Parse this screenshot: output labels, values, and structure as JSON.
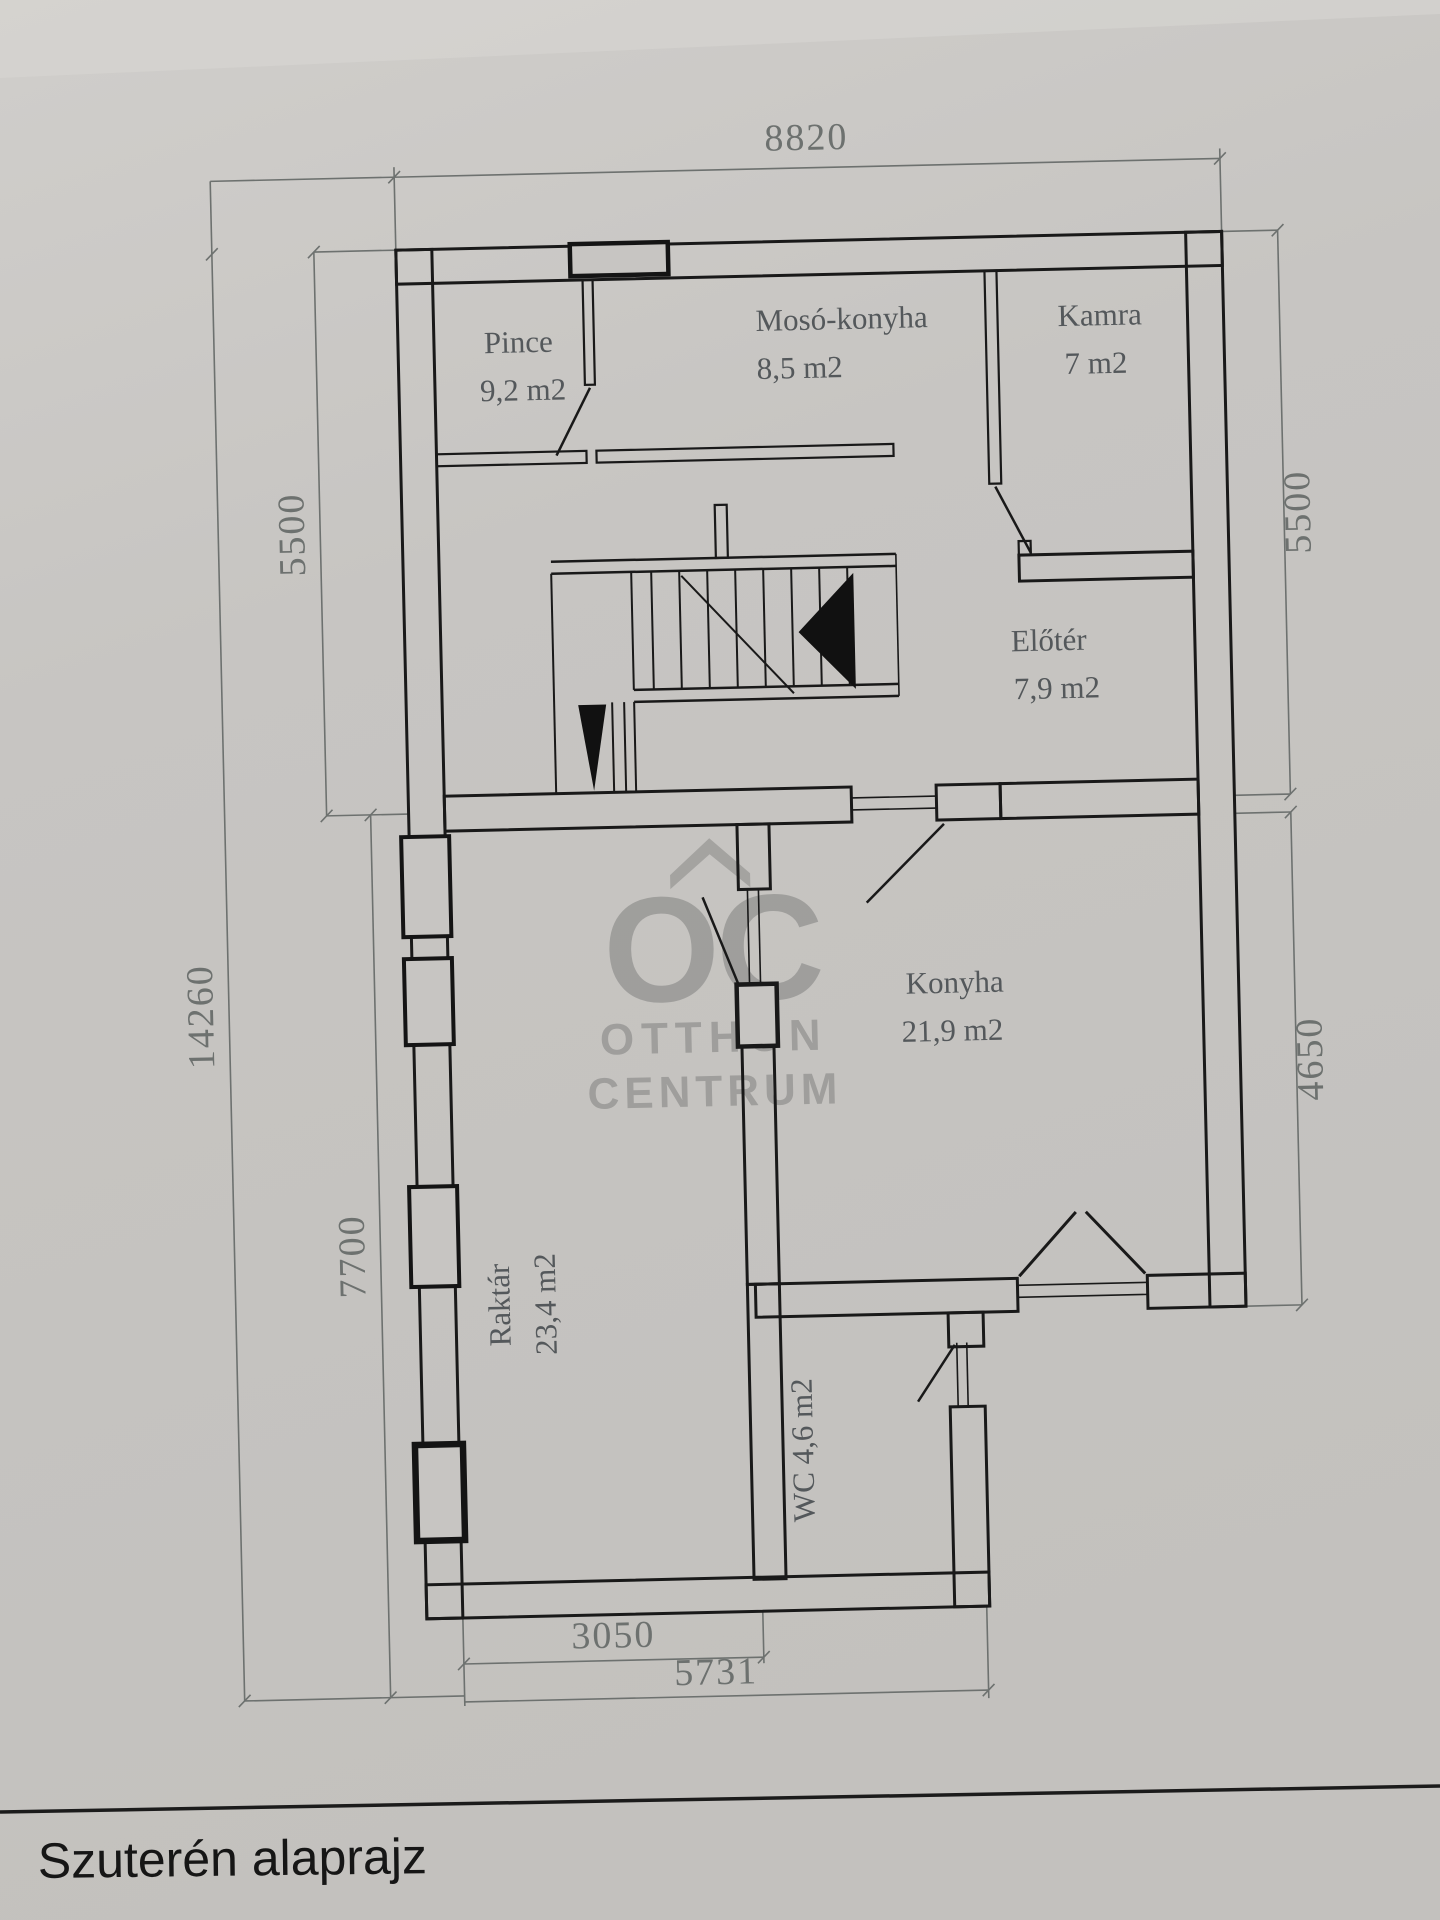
{
  "title": "Szuterén alaprajz",
  "watermark": {
    "logo": "OC",
    "line1": "OTTHON",
    "line2": "CENTRUM"
  },
  "dimensions": {
    "top": "8820",
    "left_upper": "5500",
    "right_upper": "5500",
    "left_total": "14260",
    "left_lower": "7700",
    "right_lower": "4650",
    "bottom_inner": "3050",
    "bottom_total": "5731"
  },
  "rooms": [
    {
      "name": "Pince",
      "area": "9,2 m2"
    },
    {
      "name": "Mosó-konyha",
      "area": "8,5 m2"
    },
    {
      "name": "Kamra",
      "area": "7 m2"
    },
    {
      "name": "Előtér",
      "area": "7,9 m2"
    },
    {
      "name": "Konyha",
      "area": "21,9 m2"
    },
    {
      "name": "Raktár",
      "area": "23,4 m2"
    },
    {
      "name": "WC 4,6 m2",
      "area": ""
    }
  ],
  "colors": {
    "paper": "#c7c5c2",
    "wall": "#191919",
    "dimension": "#6d716f",
    "label": "#54585b",
    "watermark": "#81817f"
  }
}
